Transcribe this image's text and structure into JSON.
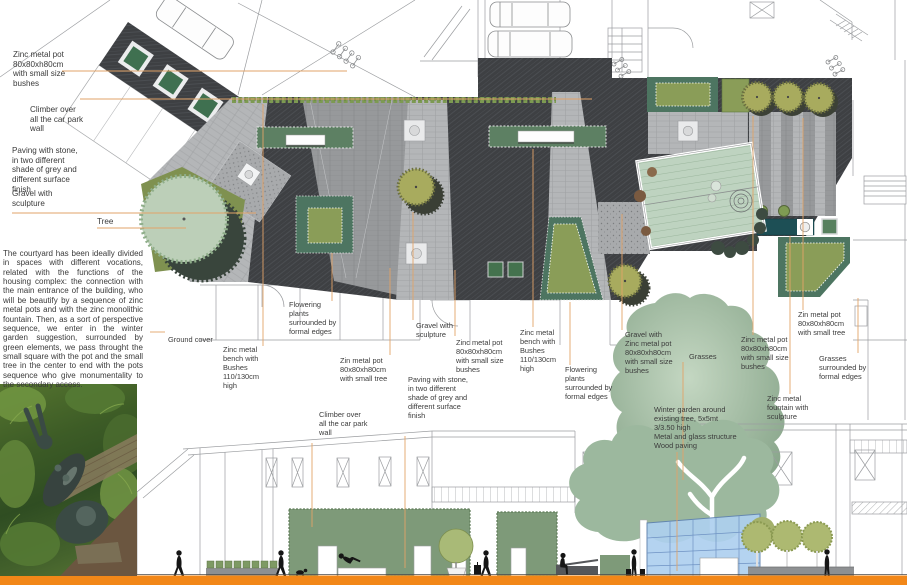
{
  "board": {
    "description_paragraph": "The courtyard has been ideally divided in spaces with different vocations, related with the functions of the housing complex: the connection with the main entrance of the building, who will be beautify by a sequence of zinc metal pots and with the zinc monolithic fountain. Then, as a sort of perspective sequence, we enter in the winter garden suggestion, surrounded by green elements, we pass throught the small square with the pot and the small tree in the center to end with the pots sequence who give monumentality to the secondary access."
  },
  "annotations": {
    "left_pot": "Zinc metal pot\n80x80xh80cm\nwith small size\nbushes",
    "left_climber": "Climber over\nall the car park\nwall",
    "left_paving": "Paving with stone,\nin two different\nshade of grey and\ndifferent surface\nfinish",
    "left_gravel": "Gravel with\nsculpture",
    "left_tree": "Tree",
    "ground_cover": "Ground cover",
    "bench1": "Zinc metal\nbench with\nBushes\n110/130cm\nhigh",
    "flowering1": "Flowering\nplants\nsurrounded by\nformal edges",
    "zin_pot_tree1": "Zin metal pot\n80x80xh80cm\nwith small tree",
    "climber2": "Climber over\nall the car park\nwall",
    "gravel2": "Gravel with\nsculpture",
    "zinc_pot2": "Zinc metal pot\n80x80xh80cm\nwith small size\nbushes",
    "paving2": "Paving with stone,\nin two different\nshade of grey and\ndifferent surface\nfinish",
    "bench2": "Zinc metal\nbench with\nBushes\n110/130cm\nhigh",
    "flowering2": "Flowering\nplants\nsurrounded by\nformal edges",
    "gravel_zinc": "Gravel with\nZinc metal pot\n80x80xh80cm\nwith small size\nbushes",
    "grasses1": "Grasses",
    "zinc_pot3": "Zinc metal pot\n80x80xh80cm\nwith small size\nbushes",
    "winter_garden": "Winter garden around\nexisting tree, 5x5mt\n3/3.50 high\nMetal and glass structure\nWood paving",
    "zin_pot_tree2": "Zin metal pot\n80x80xh80cm\nwith small tree",
    "grasses2": "Grasses\nsurrounded by\nformal edges",
    "fountain": "Zinc metal\nfountain with\nsculpture"
  },
  "colors": {
    "leader_line": "#e2a368",
    "footer_bar": "#f28718",
    "paving_dark": "#3e4043",
    "paving_light": "#b4b6b8",
    "lawn_olive": "#8a9d58",
    "bed_green": "#4d7561",
    "sage_green": "#9fbaa2",
    "teal_fountain": "#1d4f55",
    "glass_blue": "#aed0ef",
    "wall_green": "#7e9a79"
  }
}
